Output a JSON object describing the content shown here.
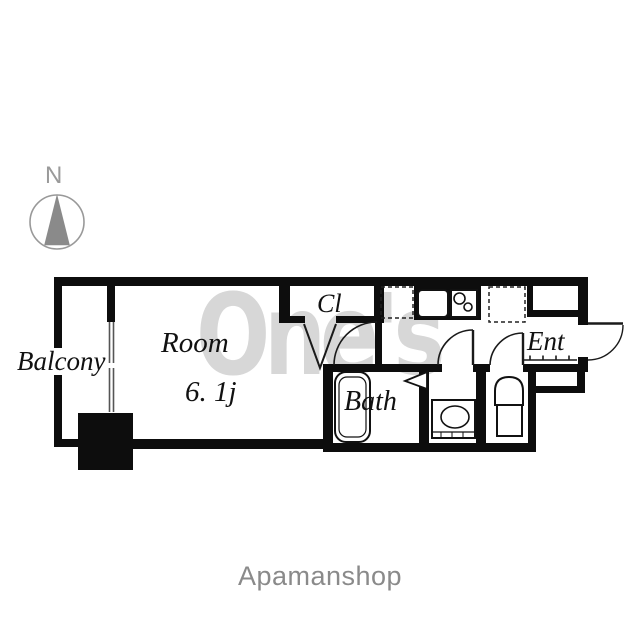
{
  "compass": {
    "label": "N"
  },
  "floorplan": {
    "labels": {
      "balcony": "Balcony",
      "room": "Room",
      "room_size": "6. 1j",
      "closet": "Cl",
      "entrance": "Ent",
      "bath": "Bath"
    },
    "fixtures": {
      "kitchen_sink": "kitchen-sink-icon",
      "stove": "two-burner-stove-icon",
      "refrigerator_space": "refrigerator-space-dashed-icon",
      "washer_space": "washer-space-dashed-icon",
      "bathtub": "bathtub-icon",
      "washbasin": "washbasin-icon",
      "toilet": "toilet-icon",
      "shoe_cabinet": "shoe-cabinet-alcove",
      "pillar": "pillar-block",
      "window": "sliding-window",
      "entry_step": "genkan-step-line"
    },
    "colors": {
      "wall": "#0d0d0d",
      "line": "#1a1a1a",
      "compass_gray": "#8a8a8a",
      "watermark_gray": "#d7d7d7",
      "brand_gray": "#8a8a8a"
    }
  },
  "watermark": {
    "text": "One's"
  },
  "footer": {
    "brand": "Apamanshop"
  }
}
